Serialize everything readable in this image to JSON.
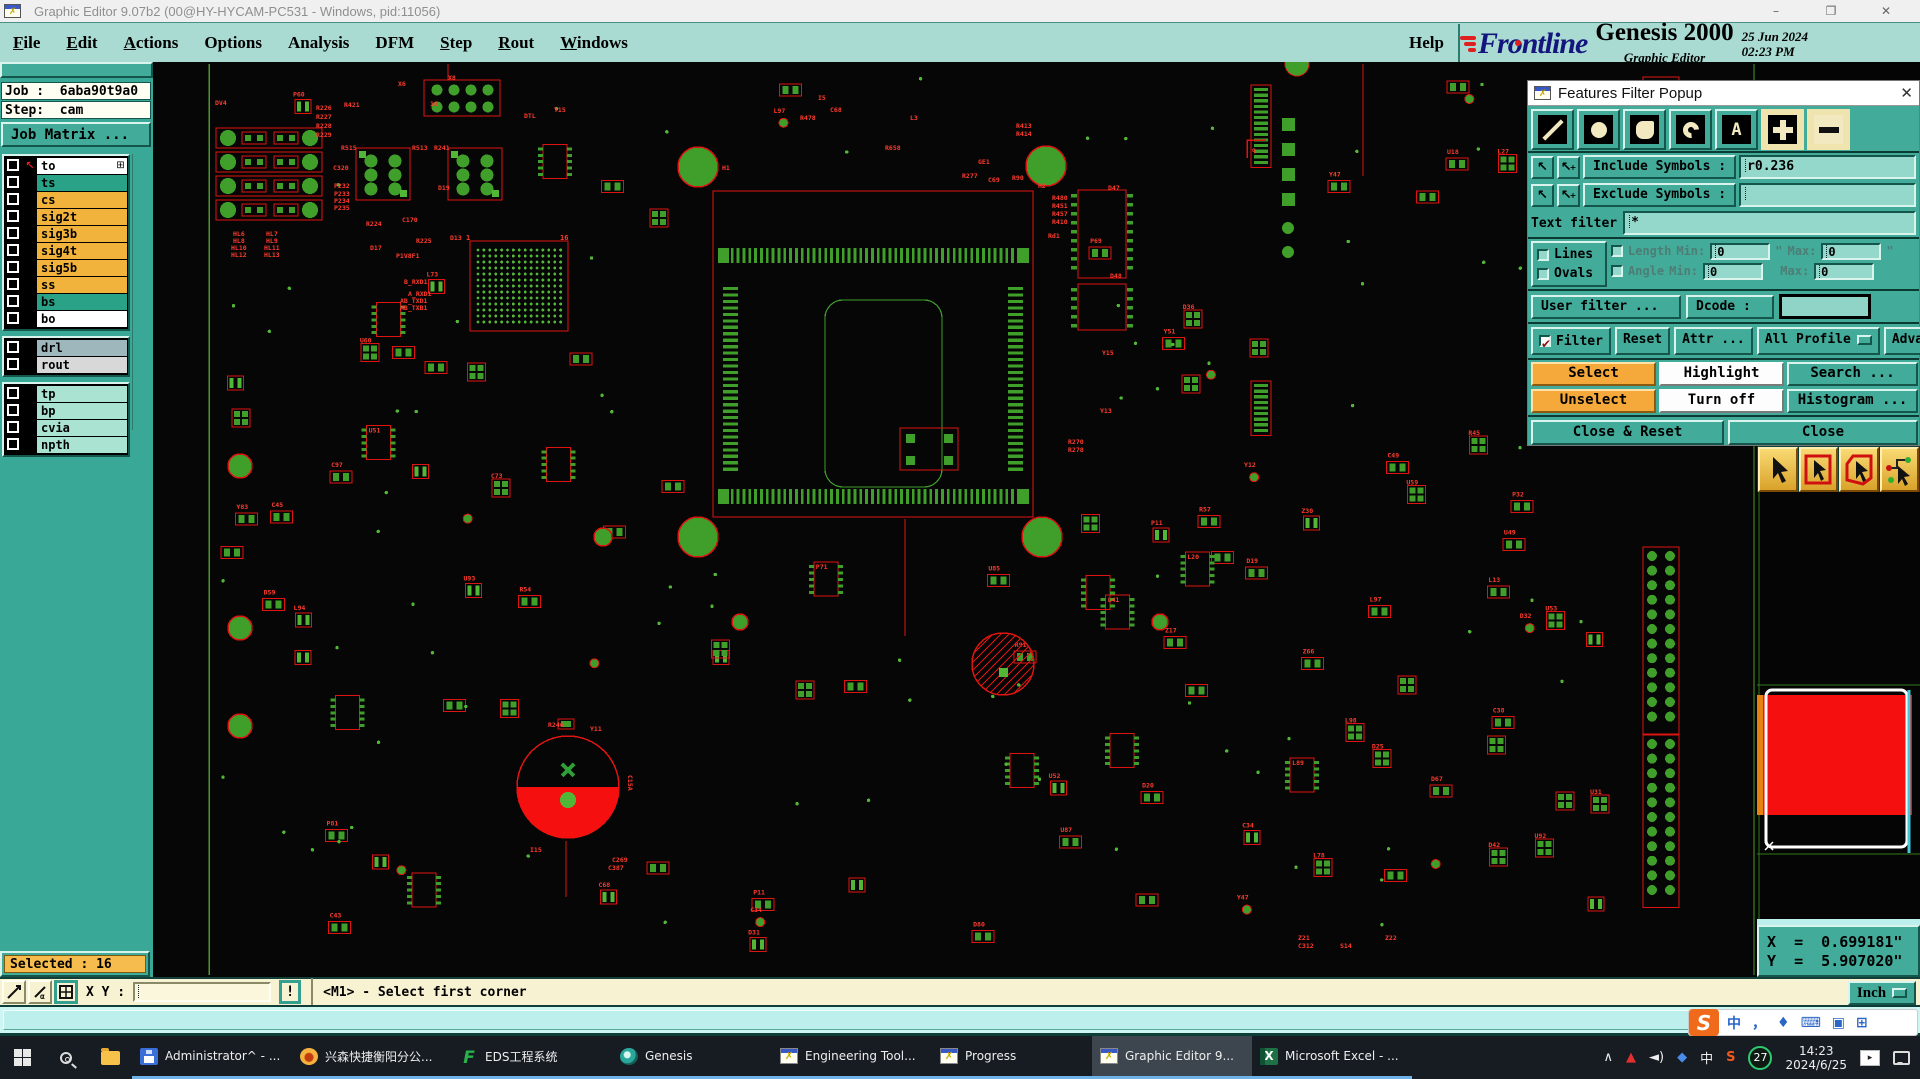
{
  "titlebar": {
    "title": "Graphic Editor 9.07b2 (00@HY-HYCAM-PC531 - Windows, pid:11056)",
    "min": "–",
    "max": "❐",
    "close": "✕"
  },
  "menubar": {
    "items": [
      {
        "label": "File",
        "underline": 0
      },
      {
        "label": "Edit",
        "underline": 0
      },
      {
        "label": "Actions",
        "underline": 0
      },
      {
        "label": "Options",
        "underline": -1
      },
      {
        "label": "Analysis",
        "underline": -1
      },
      {
        "label": "DFM",
        "underline": -1
      },
      {
        "label": "Step",
        "underline": 0
      },
      {
        "label": "Rout",
        "underline": 0
      },
      {
        "label": "Windows",
        "underline": 0
      }
    ],
    "help": "Help"
  },
  "brand": {
    "logo": "Frontline",
    "product": "Genesis 2000",
    "subtitle": "Graphic Editor",
    "date": "25 Jun 2024",
    "time": "02:23 PM"
  },
  "sidebar": {
    "job_line": "Job :  6aba90t9a0",
    "step_line": "Step:  cam",
    "matrix_button": "Job Matrix ...",
    "selected_label": "Selected : 16",
    "grid_glyph": "⊞",
    "layer_groups": [
      {
        "rows": [
          {
            "name": "to",
            "bg": "#ffffff",
            "icon": "arrow",
            "grid": true
          },
          {
            "name": "ts",
            "bg": "#29a287",
            "icon": "green"
          },
          {
            "name": "cs",
            "bg": "#f2b33d"
          },
          {
            "name": "sig2t",
            "bg": "#f2b33d"
          },
          {
            "name": "sig3b",
            "bg": "#f2b33d"
          },
          {
            "name": "sig4t",
            "bg": "#f2b33d"
          },
          {
            "name": "sig5b",
            "bg": "#f2b33d"
          },
          {
            "name": "ss",
            "bg": "#f2b33d"
          },
          {
            "name": "bs",
            "bg": "#29a287"
          },
          {
            "name": "bo",
            "bg": "#ffffff"
          }
        ]
      },
      {
        "rows": [
          {
            "name": "drl",
            "bg": "#9eb7bd"
          },
          {
            "name": "rout",
            "bg": "#d8d8d8"
          }
        ]
      },
      {
        "rows": [
          {
            "name": "tp",
            "bg": "#abe3d3"
          },
          {
            "name": "bp",
            "bg": "#abe3d3"
          },
          {
            "name": "cvia",
            "bg": "#abe3d3"
          },
          {
            "name": "npth",
            "bg": "#abe3d3"
          }
        ]
      }
    ]
  },
  "popup": {
    "title": "Features Filter Popup",
    "close": "✕",
    "tools": [
      {
        "name": "lines-tool",
        "glyph": "line",
        "on": false
      },
      {
        "name": "pads-tool",
        "glyph": "pad",
        "on": false
      },
      {
        "name": "surfaces-tool",
        "glyph": "surf",
        "on": false
      },
      {
        "name": "arcs-tool",
        "glyph": "arc",
        "on": false
      },
      {
        "name": "text-tool",
        "glyph": "text",
        "on": false
      },
      {
        "name": "plus-tool",
        "glyph": "plus",
        "on": true
      },
      {
        "name": "minus-tool",
        "glyph": "minus",
        "on": true
      }
    ],
    "arrow_glyph": "↖",
    "include_label": "Include Symbols :",
    "include_value": "r0.236",
    "exclude_label": "Exclude Symbols :",
    "exclude_value": "",
    "text_filter_label": "Text filter",
    "text_filter_value": "*",
    "lines_label": "Lines",
    "ovals_label": "Ovals",
    "length_label": "Length",
    "angle_label": "Angle",
    "min_label": "Min:",
    "max_label": "Max:",
    "len_min": "0",
    "len_max": "0",
    "ang_min": "0",
    "ang_max": "0",
    "inch_mark": "\"",
    "user_filter": "User filter ...",
    "dcode_label": "Dcode :",
    "filter_check": "Filter",
    "check_glyph": "✔",
    "reset": "Reset",
    "attr": "Attr ...",
    "all_profile": "All Profile",
    "advanced": "Advanced...",
    "select": "Select",
    "highlight": "Highlight",
    "search": "Search ...",
    "unselect": "Unselect",
    "turn_off": "Turn off",
    "histogram": "Histogram ...",
    "close_reset": "Close & Reset",
    "close_btn": "Close"
  },
  "coords": {
    "x_line": "X  =  0.699181\"",
    "y_line": "Y  =  5.907020\""
  },
  "statusbar": {
    "xy_label": "X Y :",
    "xy_value": "",
    "alert": "!",
    "message": "<M1> - Select first corner",
    "units": "Inch"
  },
  "taskbar": {
    "buttons": [
      {
        "label": "Administrator^ - ...",
        "icon": "floppy"
      },
      {
        "label": "兴森快捷衡阳分公...",
        "icon": "shell"
      },
      {
        "label": "EDS工程系统",
        "icon": "eds"
      },
      {
        "label": "Genesis",
        "icon": "genesis"
      },
      {
        "label": "Engineering Tool...",
        "icon": "xwin"
      },
      {
        "label": "Progress",
        "icon": "xwin"
      },
      {
        "label": "Graphic Editor 9...",
        "icon": "xwin",
        "active": true
      },
      {
        "label": "Microsoft Excel - ...",
        "icon": "excel"
      }
    ],
    "tray": {
      "chevron": "∧",
      "triangle": "▲",
      "speaker": "◄)",
      "bookmark": "◆",
      "ime": "中",
      "sogou_s": "S",
      "badge": "27",
      "time": "14:23",
      "date": "2024/6/25",
      "video": "▸"
    },
    "sogou_bar": {
      "logo": "S",
      "icons": [
        "中",
        "，",
        "♦",
        "⌨",
        "▣",
        "⊞"
      ]
    }
  },
  "canvas": {
    "colors": {
      "bg": "#060606",
      "silk": "#dd1410",
      "silk_bright": "#ff3b2d",
      "pad": "#3f9f2a",
      "pad_bright": "#52b737",
      "edge": "#4c9a2a",
      "cyan": "#35d8e8",
      "orange": "#e8820e",
      "white": "#ffffff"
    },
    "nav_preview": {
      "red_fill": "#f50f0f",
      "frame": "#ffffff",
      "border_green": "#2e7a1e",
      "slider_cyan": "#46c8d8",
      "strip_orange": "#e8820e"
    },
    "labels": [
      [
        "DV4",
        215,
        105
      ],
      [
        "R226",
        316,
        110
      ],
      [
        "R227",
        316,
        119
      ],
      [
        "R228",
        316,
        128
      ],
      [
        "R229",
        316,
        137
      ],
      [
        "R421",
        344,
        107
      ],
      [
        "X6",
        398,
        86
      ],
      [
        "10",
        430,
        106
      ],
      [
        "R515",
        341,
        150
      ],
      [
        "C320",
        333,
        170
      ],
      [
        "P232",
        334,
        188
      ],
      [
        "P233",
        334,
        196
      ],
      [
        "P234",
        334,
        203
      ],
      [
        "P235",
        334,
        210
      ],
      [
        "R224",
        366,
        226
      ],
      [
        "C170",
        402,
        222
      ],
      [
        "R225",
        416,
        243
      ],
      [
        "P1V8F1",
        396,
        258
      ],
      [
        "D17",
        370,
        250
      ],
      [
        "B_RXD1",
        404,
        284
      ],
      [
        "A_RXD1",
        408,
        296
      ],
      [
        "AB_TXD1",
        400,
        303
      ],
      [
        "AB_TXB1",
        400,
        310
      ],
      [
        "HL6",
        233,
        236
      ],
      [
        "HL8",
        233,
        243
      ],
      [
        "HL10",
        231,
        250
      ],
      [
        "HL12",
        231,
        257
      ],
      [
        "HL7",
        266,
        236
      ],
      [
        "HL9",
        266,
        243
      ],
      [
        "HL11",
        264,
        250
      ],
      [
        "HL13",
        264,
        257
      ],
      [
        "DTL",
        524,
        118
      ],
      [
        "Y15",
        554,
        112
      ],
      [
        "R513",
        412,
        150
      ],
      [
        "R241",
        434,
        150
      ],
      [
        "D19",
        438,
        190
      ],
      [
        "D13",
        450,
        240
      ],
      [
        "H1",
        722,
        170
      ],
      [
        "H2",
        1038,
        188
      ],
      [
        "R277",
        962,
        178
      ],
      [
        "GE1",
        978,
        164
      ],
      [
        "C69",
        988,
        182
      ],
      [
        "R90",
        1012,
        180
      ],
      [
        "R413",
        1016,
        128
      ],
      [
        "R414",
        1016,
        136
      ],
      [
        "D47",
        1108,
        190
      ],
      [
        "D48",
        1110,
        278
      ],
      [
        "Y15",
        1102,
        355
      ],
      [
        "Y13",
        1100,
        413
      ],
      [
        "R270",
        1068,
        444
      ],
      [
        "R278",
        1068,
        452
      ],
      [
        "R480",
        1052,
        200
      ],
      [
        "R451",
        1052,
        208
      ],
      [
        "R457",
        1052,
        216
      ],
      [
        "R410",
        1052,
        224
      ],
      [
        "Rd1",
        1048,
        238
      ],
      [
        "R246",
        548,
        727
      ],
      [
        "Y11",
        590,
        731
      ],
      [
        "I15",
        530,
        852
      ],
      [
        "C269",
        612,
        862
      ],
      [
        "C387",
        608,
        870
      ],
      [
        "Z21",
        1298,
        940
      ],
      [
        "S14",
        1340,
        948
      ],
      [
        "Z22",
        1385,
        940
      ],
      [
        "C312",
        1298,
        948
      ],
      [
        "X8",
        448,
        80
      ],
      [
        "L3",
        910,
        120
      ],
      [
        "R478",
        800,
        120
      ],
      [
        "R658",
        885,
        150
      ],
      [
        "C68",
        830,
        112
      ],
      [
        "I5",
        818,
        100
      ]
    ],
    "label_prefixes": [
      "R",
      "C",
      "D",
      "P",
      "U",
      "Y",
      "L",
      "Z"
    ]
  }
}
